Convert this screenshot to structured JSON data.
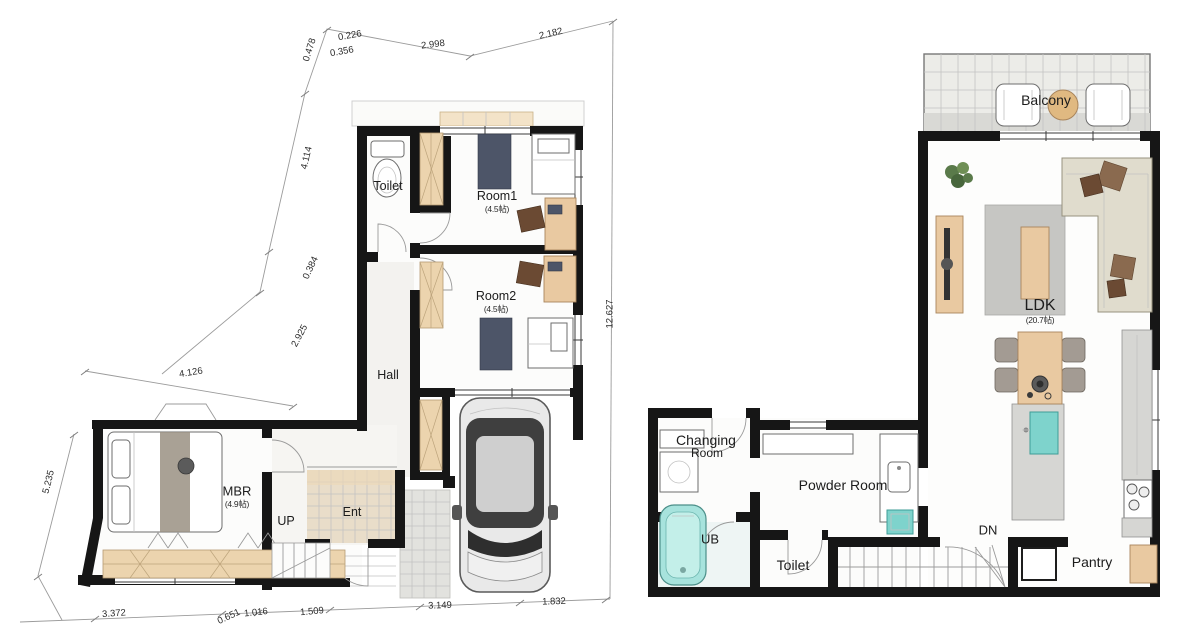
{
  "document": {
    "type": "floor-plan",
    "sheet_bg": "#ffffff",
    "wall_color": "#161616",
    "wood_color": "#e9c9a1",
    "tile_teal": "#7ed3cc"
  },
  "floor1": {
    "labels": {
      "toilet": "Toilet",
      "room1": "Room1",
      "room1_size": "(4.5帖)",
      "room2": "Room2",
      "room2_size": "(4.5帖)",
      "hall": "Hall",
      "mbr": "MBR",
      "mbr_size": "(4.9帖)",
      "up": "UP",
      "ent": "Ent"
    },
    "dimensions": {
      "top": [
        "0.478",
        "0.226",
        "0.356",
        "2.998",
        "2.182"
      ],
      "left": [
        "4.114",
        "0.384",
        "2.925",
        "4.126",
        "5.235"
      ],
      "right": [
        "12.627"
      ],
      "bottom": [
        "3.372",
        "0.651",
        "1.016",
        "1.509",
        "3.149",
        "1.832"
      ]
    }
  },
  "floor2": {
    "labels": {
      "balcony": "Balcony",
      "ldk": "LDK",
      "ldk_size": "(20.7帖)",
      "changing_line1": "Changing",
      "changing_line2": "Room",
      "powder": "Powder Room",
      "ub": "UB",
      "toilet": "Toilet",
      "dn": "DN",
      "pantry": "Pantry"
    }
  }
}
